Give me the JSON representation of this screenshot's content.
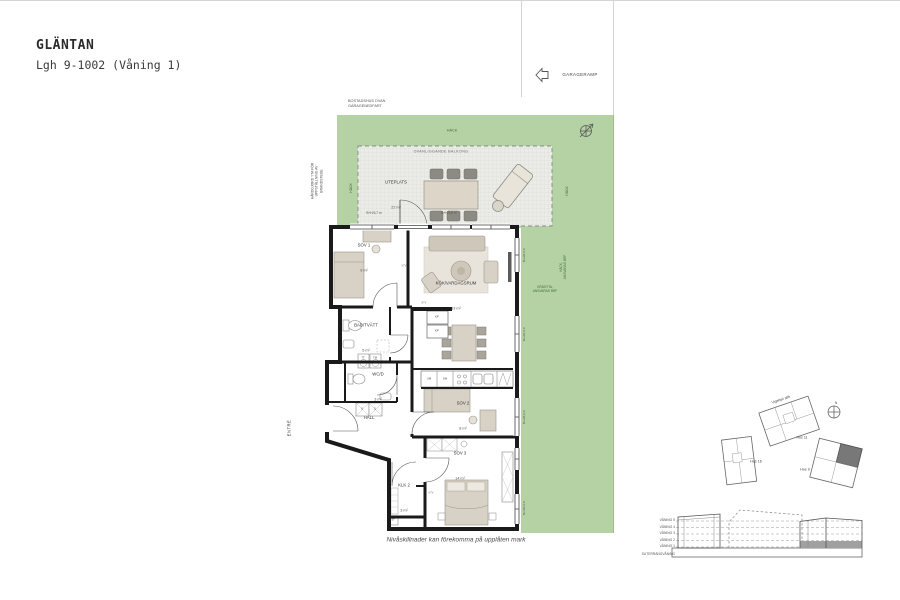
{
  "header": {
    "project": "GLÄNTAN",
    "apartment": "Lgh 9-1002 (Våning 1)"
  },
  "notes": {
    "garageramp": "GARAGERAMP",
    "above_garage": "BOSTADSHUS OVAN\nGARAGENEDFART",
    "fire_access": "HÅRDGJORD YTA FÖR\nUPPSTÄLLNING AV\nBRANDSTEGE",
    "hedge_top": "HÄCK",
    "hedge_left": "HÄCK",
    "hedge_right": "HÄCK",
    "hedge_resp": "HÄCK,\nANSVARAS BRF",
    "lawn_resp": "GRÄSYTA,\nANSVARAS BRF",
    "entrance": "ENTRÉ",
    "footnote": "Nivåskillnader kan förekomma på upplåten mark"
  },
  "terrace": {
    "balcony_above": "OVANLIGGANDE BALKONG",
    "name": "UTEPLATS",
    "area": "22 m²",
    "dim_left": "B+H/3,7 m",
    "dim_mid": "B+H/2,6 m"
  },
  "window_dims": [
    "B+H/0,9 m",
    "B+H/0,9 m",
    "B+H/0,9 m",
    "B+H/0,9 m"
  ],
  "rooms": [
    {
      "name": "SOV 1",
      "area": "9 m²"
    },
    {
      "name": "KÖK/VARDAGSRUM",
      "area": "33 m²"
    },
    {
      "name": "BAD/TVÄTT",
      "area": "5 m²"
    },
    {
      "name": "WC/D",
      "area": "3 m²"
    },
    {
      "name": "HALL",
      "area": ""
    },
    {
      "name": "SOV 2",
      "area": "8 m²"
    },
    {
      "name": "SOV 3",
      "area": "14 m²"
    },
    {
      "name": "KLK 2",
      "area": "3 m²"
    }
  ],
  "fixtures": {
    "tt": "TT",
    "tm": "TM",
    "um": "UM",
    "dm": "DM",
    "kf1": "K/F",
    "kf2": "K/F",
    "g1": "G",
    "g2": "G",
    "st": "ST",
    "ktv": "KTV"
  },
  "siteplan": {
    "street": "Vigelsjö allé",
    "hus11": "Hus 11",
    "hus16": "Hus 16",
    "hus9": "Hus 9",
    "north": "N"
  },
  "elevation": {
    "levels": [
      "VÅNING 5",
      "VÅNING 4",
      "VÅNING 3",
      "VÅNING 2",
      "VÅNING 1",
      "SUTERRÄNGVÅNING"
    ]
  },
  "colors": {
    "lawn_green": "#b4d2a4",
    "plan_wall": "#1a1a1a",
    "highlight_gray": "#787878",
    "furniture_tan": "#d8d1c5",
    "green_text": "#3f6e3a"
  }
}
